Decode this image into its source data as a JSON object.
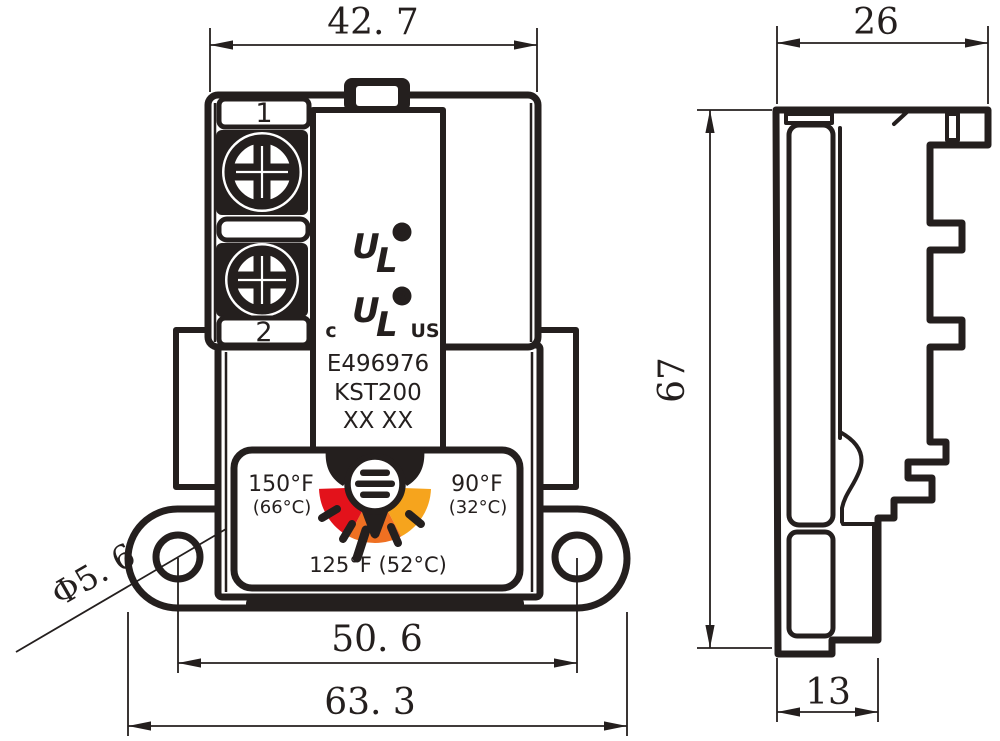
{
  "colors": {
    "line": "#241f1e",
    "background": "#ffffff",
    "dial_red": "#e3121b",
    "dial_orange": "#ef7022",
    "dial_amber": "#f6a41d"
  },
  "front_view": {
    "dims": {
      "top_width": "42. 7",
      "hole_spacing": "50. 6",
      "overall_width": "63. 3",
      "hole_diameter": "Φ5. 6"
    },
    "terminals": {
      "t1": "1",
      "t2": "2"
    },
    "cert": {
      "u": "U",
      "l": "L",
      "r": "R",
      "c": "c",
      "us": "US"
    },
    "labels": {
      "file_no": "E496976",
      "model": "KST200",
      "date_code": "XX XX"
    },
    "dial": {
      "left_f": "150°F",
      "left_c": "(66°C)",
      "right_f": "90°F",
      "right_c": "(32°C)",
      "bottom": "125°F (52°C)"
    }
  },
  "side_view": {
    "dims": {
      "depth": "26",
      "height": "67",
      "foot_depth": "13"
    }
  }
}
